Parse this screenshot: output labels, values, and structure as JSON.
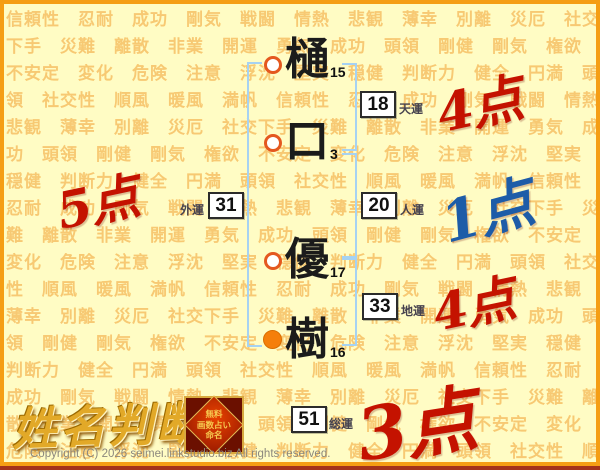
{
  "page": {
    "copyright": "Copyright (C) 2026 seimei.linkstudio.biz All rights reserved."
  },
  "logo": {
    "title": "姓名判断",
    "badge_lines": [
      "無料",
      "画数占い",
      "命名"
    ]
  },
  "background": {
    "words": [
      "信頼性",
      "忍耐",
      "成功",
      "剛気",
      "戦闘",
      "情熱",
      "悲観",
      "薄幸",
      "別離",
      "災厄",
      "社交下手",
      "災難",
      "離散",
      "非業",
      "開運",
      "勇気",
      "成功",
      "頭領",
      "剛健",
      "剛気",
      "権欲",
      "不安定",
      "変化",
      "危険",
      "注意",
      "浮沈",
      "堅実",
      "穏健",
      "判断力",
      "健全",
      "円満",
      "頭領",
      "社交性",
      "順風",
      "暖風",
      "満帆"
    ]
  },
  "name": {
    "characters": [
      {
        "char": "樋",
        "strokes": "15",
        "marker": "outline-circle"
      },
      {
        "char": "口",
        "strokes": "3",
        "marker": "outline-circle"
      },
      {
        "char": "優",
        "strokes": "17",
        "marker": "outline-circle"
      },
      {
        "char": "樹",
        "strokes": "16",
        "marker": "filled-circle"
      }
    ]
  },
  "fortunes": [
    {
      "id": "tenun",
      "value": "18",
      "label": "天運",
      "score": "4点",
      "score_style": "red"
    },
    {
      "id": "gaiun",
      "value": "31",
      "label": "外運",
      "score": "5点",
      "score_style": "red"
    },
    {
      "id": "jinun",
      "value": "20",
      "label": "人運",
      "score": "1点",
      "score_style": "blue"
    },
    {
      "id": "chiun",
      "value": "33",
      "label": "地運",
      "score": "4点",
      "score_style": "red"
    },
    {
      "id": "soun",
      "value": "51",
      "label": "総運",
      "score": "3点",
      "score_style": "red"
    }
  ],
  "colors": {
    "frame_orange": "#F59E14",
    "frame_bottom_red": "#A3321C",
    "paper": "#FFFCC4",
    "pattern_word": "#F6BD5F",
    "bracket_blue": "#A6D2F2",
    "marker_ring": "#E4581F",
    "marker_fill": "#F57F0A",
    "score_red": "#C41200",
    "score_blue": "#1D5CA8",
    "logo_gold": "#E2A928",
    "badge_red": "#9C1B00"
  }
}
